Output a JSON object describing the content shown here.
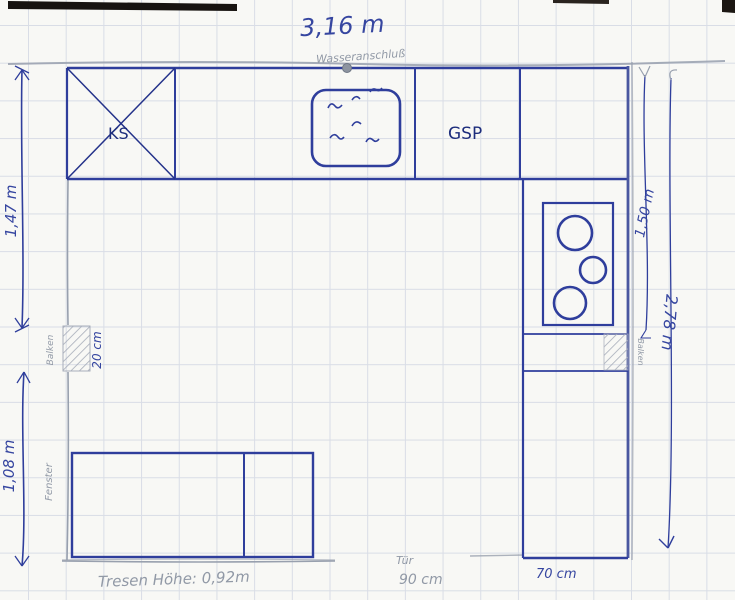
{
  "plan": {
    "dimensions": {
      "top_width": "3,16 m",
      "left_upper": "1,47 m",
      "left_lower": "1,08 m",
      "right_inner": "1,50 m",
      "right_outer": "2,78 m",
      "beam_depth": "20 cm",
      "door_width": "90 cm",
      "column_width": "70 cm",
      "counter_note": "Tresen Höhe: 0,92m"
    },
    "labels": {
      "fridge": "KS",
      "dishwasher": "GSP",
      "water_connection": "Wasseranschluß",
      "window": "Fenster",
      "beam_left": "Balken",
      "beam_right": "Balken",
      "door": "Tür"
    },
    "colors": {
      "pen": "#2f3e9c",
      "pencil": "#98a0ae",
      "paper": "#f8f8f5",
      "grid": "#d9dde6"
    }
  }
}
